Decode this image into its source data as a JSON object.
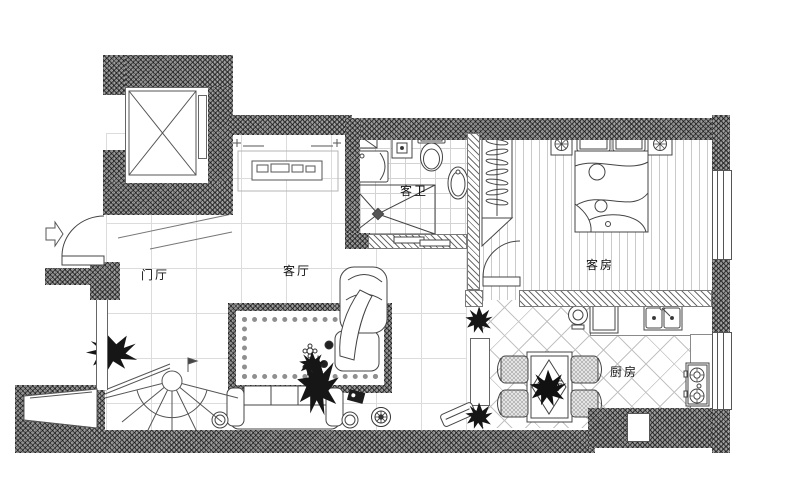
{
  "rooms": {
    "entry": {
      "label": "门厅"
    },
    "living": {
      "label": "客厅"
    },
    "bath": {
      "label": "客卫"
    },
    "bedroom": {
      "label": "客房"
    },
    "dining": {
      "label": "餐厅"
    },
    "kitchen": {
      "label": "厨房"
    }
  },
  "colors": {
    "wall_fill": "#a0a0a0",
    "line": "#444444",
    "floor_grid": "#dcdcdc",
    "background": "#ffffff"
  }
}
